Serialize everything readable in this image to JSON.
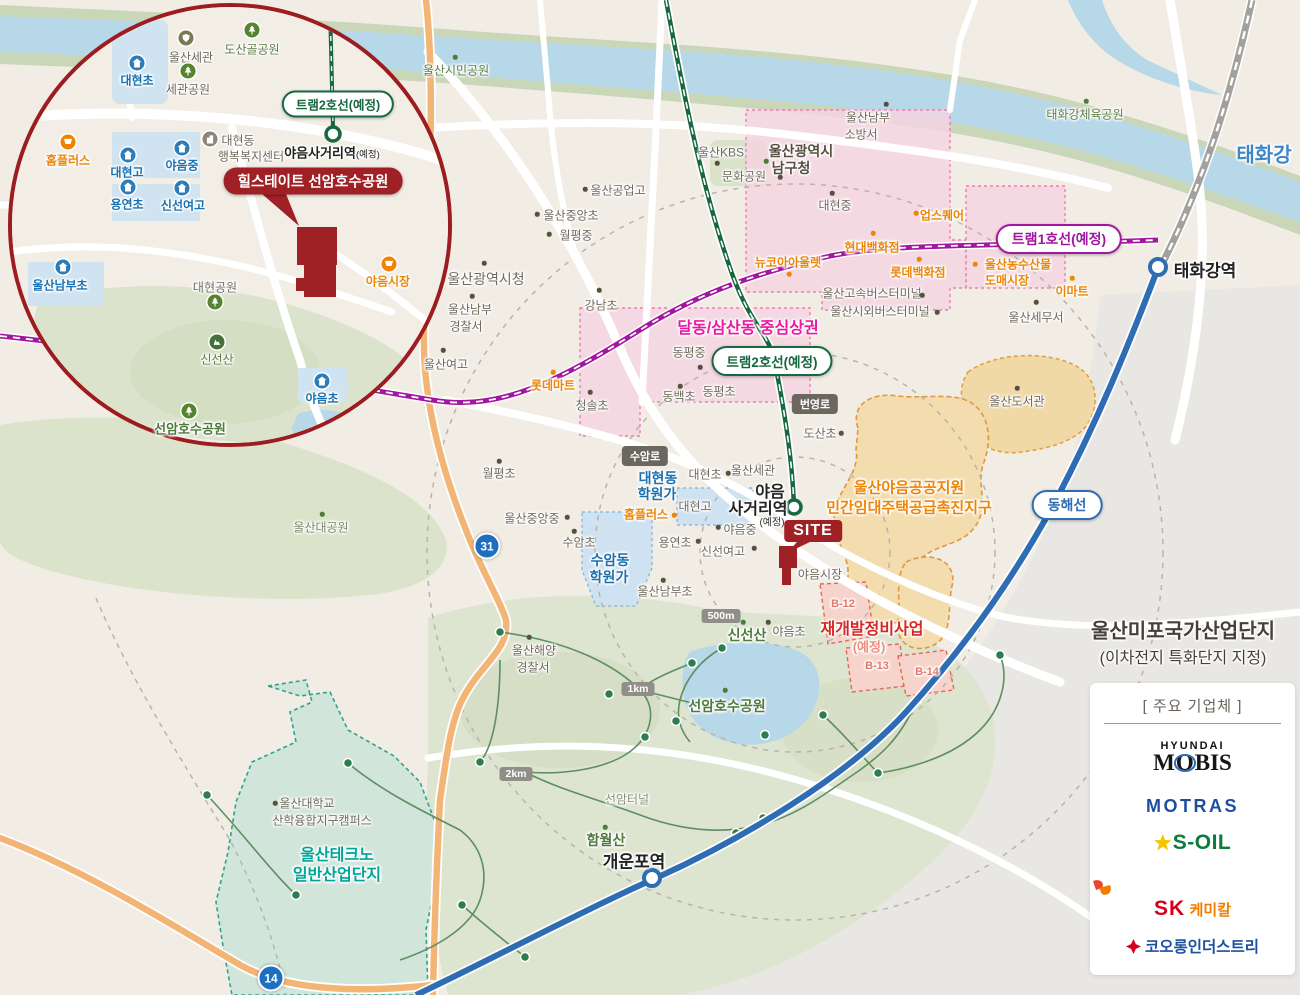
{
  "inset": {
    "tram2_badge": "트램2호선(예정)",
    "station_name": "야음사거리역",
    "station_suffix": "(예정)",
    "site_badge": "힐스테이트 선암호수공원",
    "places": {
      "ulsan_customs": "울산세관",
      "dosangol_park": "도산골공원",
      "daehyeon_elem": "대현초",
      "segwan_park": "세관공원",
      "homeplus": "홈플러스",
      "center_l1": "대현동",
      "center_l2": "행복복지센터",
      "daehyeon_high": "대현고",
      "yaeum_middle": "야음중",
      "yongyeon_elem": "용연초",
      "sinseon_girls": "신선여고",
      "yaeum_market": "야음시장",
      "nambu_elem": "울산남부초",
      "daehyeon_park": "대현공원",
      "sinseon_mtn": "신선산",
      "yaeum_elem": "야음초",
      "seonam_lake_park": "선암호수공원"
    }
  },
  "map": {
    "river": "태화강",
    "badges": {
      "tram1": "트램1호선(예정)",
      "tram2": "트램2호선(예정)",
      "donghae": "동해선",
      "byeongyeong_ro": "번영로",
      "suam_ro": "수암로",
      "r500m": "500m",
      "r1km": "1km",
      "r2km": "2km",
      "road31": "31",
      "road14": "14",
      "site": "SITE"
    },
    "stations": {
      "taehwagang": "태화강역",
      "gaeunpo": "개운포역",
      "yaeum_l1": "야음",
      "yaeum_l2": "사거리역",
      "yaeum_suffix": "(예정)"
    },
    "zones": {
      "dalsam": "달동/삼산동 중심상권",
      "public_l1": "울산야음공공지원",
      "public_l2": "민간임대주택공급촉진지구",
      "redev_l1": "재개발정비사업",
      "redev_l2": "(예정)",
      "b12": "B-12",
      "b13": "B-13",
      "b14": "B-14",
      "techno_l1": "울산테크노",
      "techno_l2": "일반산업단지",
      "mipo_l1": "울산미포국가산업단지",
      "mipo_l2": "(이차전지 특화단지 지정)"
    },
    "places": {
      "citizen_park": "울산시민공원",
      "kbs": "울산KBS",
      "munhwa_park": "문화공원",
      "namgu_l1": "울산광역시",
      "namgu_l2": "남구청",
      "fire_l1": "울산남부",
      "fire_l2": "소방서",
      "sports_park": "태화강체육공원",
      "tech_high": "울산공업고",
      "jungang_elem": "울산중앙초",
      "wolpyeong_mid": "월평중",
      "cityhall": "울산광역시청",
      "police_l1": "울산남부",
      "police_l2": "경찰서",
      "gangnam": "강남초",
      "yeogo": "울산여고",
      "lottemart": "롯데마트",
      "upsquare": "업스퀘어",
      "hyundai_dept": "현대백화점",
      "newcore": "뉴코아아울렛",
      "lotte_dept": "롯데백화점",
      "express_terminal": "울산고속버스터미널",
      "intercity_terminal": "울산시외버스터미널",
      "fish_l1": "울산농수산물",
      "fish_l2": "도매시장",
      "emart": "이마트",
      "tax_office": "울산세무서",
      "daehyeon_mid": "대현중",
      "cheongsol": "청솔초",
      "dongpyeong_mid": "동평중",
      "dongbaek": "동백초",
      "dongpyeong_elem": "동평초",
      "dosan": "도산초",
      "wolpyeong_elem": "월평초",
      "hagwon1_l1": "대현동",
      "hagwon1_l2": "학원가",
      "homeplus": "홈플러스",
      "daehyeon_high": "대현고",
      "daehyeon_elem": "대현초",
      "customs": "울산세관",
      "jungang_mid": "울산중앙중",
      "suam_elem": "수암초",
      "hagwon2_l1": "수암동",
      "hagwon2_l2": "학원가",
      "yongyeon": "용연초",
      "yaeum_mid": "야음중",
      "sinseon_girls": "신선여고",
      "nambu_elem": "울산남부초",
      "yaeum_market": "야음시장",
      "library": "울산도서관",
      "sinseon_mtn": "신선산",
      "yaeum_elem": "야음초",
      "coastg_l1": "울산해양",
      "coastg_l2": "경찰서",
      "seonam_park": "선암호수공원",
      "seonam_tunnel": "선암터널",
      "hamwol_mtn": "함월산",
      "grand_park": "울산대공원",
      "univ_l1": "울산대학교",
      "univ_l2": "산학융합지구캠퍼스"
    }
  },
  "legend": {
    "title": "[ 주요 기업체 ]",
    "companies": [
      {
        "name": "HYUNDAI MOBIS",
        "line1": "HYUNDAI",
        "parts": [
          "M",
          "O",
          "BIS"
        ]
      },
      {
        "name": "MOTRAS",
        "text": "MOTRAS"
      },
      {
        "name": "S-OIL",
        "text": "S-OIL"
      },
      {
        "name": "SK케미칼",
        "sk": "SK",
        "suffix": "케미칼"
      },
      {
        "name": "코오롱인더스트리",
        "text": "코오롱인더스트리"
      }
    ]
  },
  "colors": {
    "site_red": "#a02125",
    "tram1_purple": "#a217a0",
    "tram2_green": "#17673f",
    "donghae_blue": "#2e6cb4",
    "commercial_pink": "#ea18a2",
    "promotion_orange": "#ed8508",
    "techno_teal": "#00a598"
  }
}
